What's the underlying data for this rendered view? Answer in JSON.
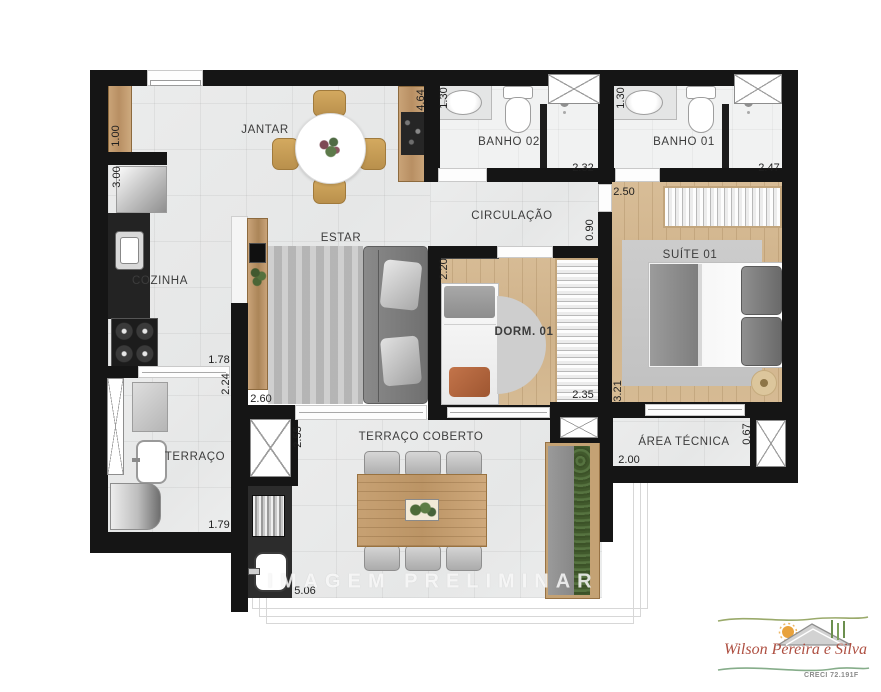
{
  "plan": {
    "watermark": "IMAGEM PRELIMINAR",
    "rooms": {
      "jantar": "JANTAR",
      "cozinha": "COZINHA",
      "estar": "ESTAR",
      "circulacao": "CIRCULAÇÃO",
      "banho02": "BANHO 02",
      "banho01": "BANHO 01",
      "dorm01": "DORM. 01",
      "suite01": "SUÍTE 01",
      "terraco": "TERRAÇO",
      "terraco_coberto": "TERRAÇO COBERTO",
      "area_tecnica": "ÁREA TÉCNICA"
    },
    "dimensions": {
      "hall_niche": "1.00",
      "cozinha_len": "3.00",
      "jantar_depth": "4.64",
      "banho02_w": "1.30",
      "banho02_len": "2.32",
      "banho01_w": "1.30",
      "banho01_len": "2.47",
      "suite_w": "2.50",
      "circ_w": "0.90",
      "dorm_w": "2.20",
      "dorm_len": "2.35",
      "suite_len": "3.21",
      "estar_w": "2.60",
      "cozinha_w": "1.78",
      "cozinha_d": "2.24",
      "tc_w": "2.55",
      "terraco_w": "1.79",
      "tc_len": "5.06",
      "at_len": "2.00",
      "at_w": "0.67"
    },
    "logo": {
      "name": "Wilson Pereira e Silva",
      "creci": "CRECI 72.191F"
    },
    "colors": {
      "wall": "#151515",
      "tile": "#e9eaea",
      "wood_floor": "#d2b48f",
      "logo_text": "#ae4f41",
      "logo_green": "#9aaa6b"
    }
  }
}
